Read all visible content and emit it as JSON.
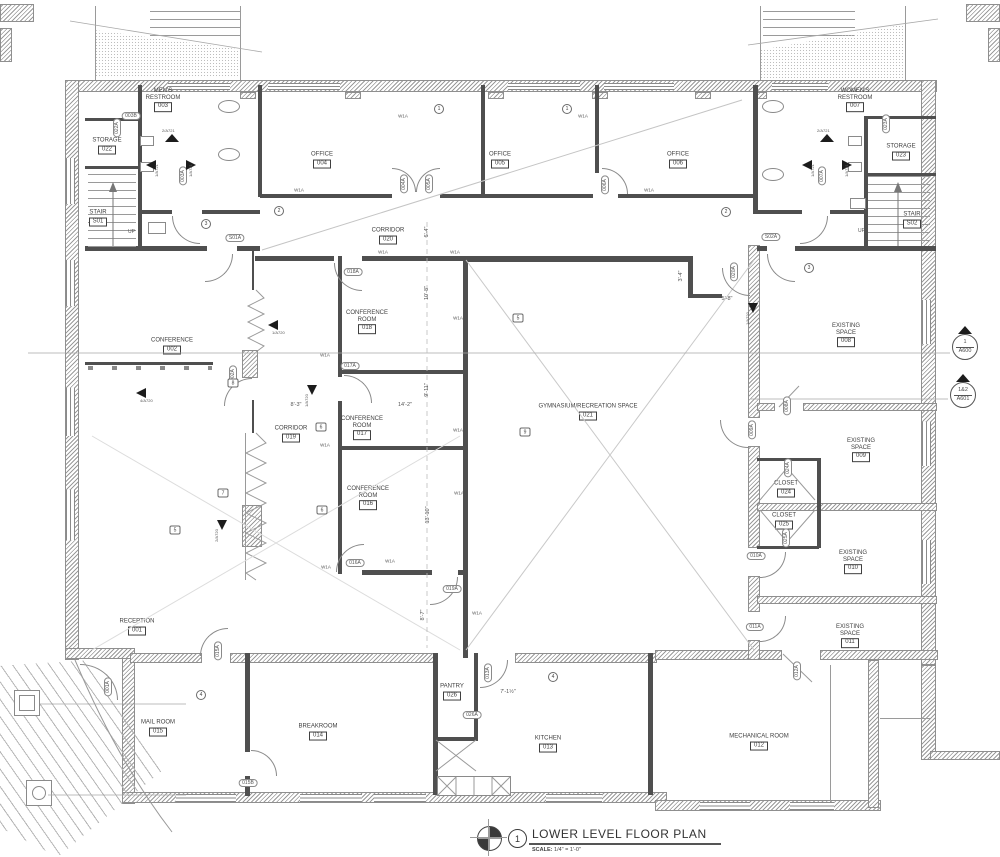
{
  "title_block": {
    "detail_number": "1",
    "title": "LOWER LEVEL FLOOR PLAN",
    "scale_label": "SCALE:",
    "scale_value": "1/4\" = 1'-0\""
  },
  "misc": {
    "up": "UP",
    "wall_tag": "W1A"
  },
  "rooms": [
    {
      "name": "MEN'S RESTROOM",
      "number": "003"
    },
    {
      "name": "STORAGE",
      "number": "022"
    },
    {
      "name": "STAIR",
      "number": "S01"
    },
    {
      "name": "OFFICE",
      "number": "004"
    },
    {
      "name": "OFFICE",
      "number": "005"
    },
    {
      "name": "OFFICE",
      "number": "006"
    },
    {
      "name": "WOMEN'S RESTROOM",
      "number": "007"
    },
    {
      "name": "STORAGE",
      "number": "023"
    },
    {
      "name": "STAIR",
      "number": "S02"
    },
    {
      "name": "CORRIDOR",
      "number": "020"
    },
    {
      "name": "CONFERENCE",
      "number": "002"
    },
    {
      "name": "CONFERENCE ROOM",
      "number": "018"
    },
    {
      "name": "CONFERENCE ROOM",
      "number": "017"
    },
    {
      "name": "CORRIDOR",
      "number": "019"
    },
    {
      "name": "CONFERENCE ROOM",
      "number": "016"
    },
    {
      "name": "GYMNASIUM/RECREATION SPACE",
      "number": "021"
    },
    {
      "name": "EXISTING SPACE",
      "number": "008"
    },
    {
      "name": "EXISTING SPACE",
      "number": "009"
    },
    {
      "name": "CLOSET",
      "number": "024"
    },
    {
      "name": "CLOSET",
      "number": "025"
    },
    {
      "name": "EXISTING SPACE",
      "number": "010"
    },
    {
      "name": "EXISTING SPACE",
      "number": "011"
    },
    {
      "name": "RECEPTION",
      "number": "001"
    },
    {
      "name": "MAIL ROOM",
      "number": "015"
    },
    {
      "name": "BREAKROOM",
      "number": "014"
    },
    {
      "name": "PANTRY",
      "number": "026"
    },
    {
      "name": "KITCHEN",
      "number": "013"
    },
    {
      "name": "MECHANICAL ROOM",
      "number": "012"
    }
  ],
  "door_tags": [
    "003B",
    "022A",
    "003A",
    "S01A",
    "004A",
    "005A",
    "006A",
    "S02A",
    "007A",
    "023A",
    "018A",
    "017A",
    "002A",
    "016A",
    "019A",
    "020A",
    "008A",
    "009A",
    "024A",
    "025A",
    "010A",
    "011A",
    "001A",
    "015A",
    "015B",
    "026A",
    "013A",
    "012A"
  ],
  "dims": [
    "6'-4\"",
    "10'-8\"",
    "9'-11\"",
    "14'-2\"",
    "8'-3\"",
    "13'-10\"",
    "8'-7\"",
    "3'-4\"",
    "5'-8\"",
    "7'-1½\""
  ],
  "kc": [
    "3",
    "2",
    "1",
    "1",
    "2",
    "3",
    "4",
    "4"
  ],
  "kh": [
    "5",
    "9",
    "6",
    "6",
    "7",
    "5",
    "8"
  ],
  "elev": [
    "2/A721",
    "1/A721",
    "1/A721",
    "2/A721",
    "1/A721",
    "1/A721",
    "4/A720",
    "1/A720",
    "1/A720",
    "2/A720",
    "1/A720"
  ],
  "sect": [
    {
      "number": "1",
      "sheet": "A600"
    },
    {
      "number": "1&2",
      "sheet": "A601"
    }
  ]
}
